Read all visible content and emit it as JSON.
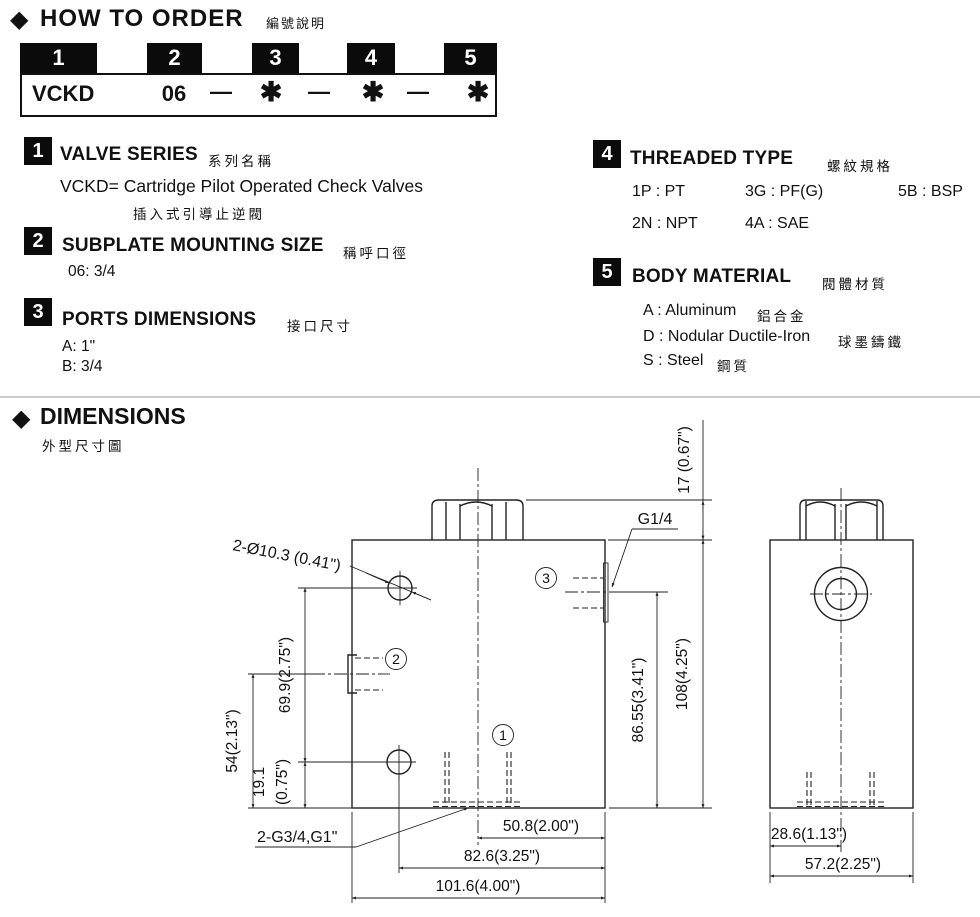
{
  "header": {
    "diamond": "◆",
    "title": "HOW TO ORDER",
    "title_zh": "編號說明"
  },
  "code_table": {
    "numbers": [
      "1",
      "2",
      "3",
      "4",
      "5"
    ],
    "model": "VCKD",
    "size": "06",
    "dash": "—",
    "star": "✱"
  },
  "sections": {
    "s1": {
      "num": "1",
      "title": "VALVE SERIES",
      "zh": "系列名稱",
      "line1": "VCKD=  Cartridge Pilot Operated Check Valves",
      "line2": "插入式引導止逆閥"
    },
    "s2": {
      "num": "2",
      "title": "SUBPLATE MOUNTING SIZE",
      "zh": "稱呼口徑",
      "line1": "06: 3/4"
    },
    "s3": {
      "num": "3",
      "title": "PORTS DIMENSIONS",
      "zh": "接口尺寸",
      "line1": "A: 1\"",
      "line2": "B: 3/4"
    },
    "s4": {
      "num": "4",
      "title": "THREADED TYPE",
      "zh": "螺紋規格",
      "opt1": "1P : PT",
      "opt2": "3G : PF(G)",
      "opt3": "5B : BSP",
      "opt4": "2N : NPT",
      "opt5": "4A : SAE"
    },
    "s5": {
      "num": "5",
      "title": "BODY MATERIAL",
      "zh": "閥體材質",
      "item1": "A : Aluminum",
      "item1_zh": "鋁合金",
      "item2": "D : Nodular Ductile-Iron",
      "item2_zh": "球墨鑄鐵",
      "item3": "S : Steel",
      "item3_zh": "鋼質"
    }
  },
  "dimensions": {
    "diamond": "◆",
    "title": "DIMENSIONS",
    "title_zh": "外型尺寸圖",
    "labels": {
      "mount_holes": "2-Ø10.3 (0.41\")",
      "pilot_port": "G1/4",
      "bottom_ports": "2-G3/4,G1\"",
      "cap_height": "17 (0.67\")",
      "v_69_9": "69.9(2.75\")",
      "v_54": "54(2.13\")",
      "v_19_1a": "19.1",
      "v_19_1b": "(0.75\")",
      "v_86_55": "86.55(3.41\")",
      "v_108": "108(4.25\")",
      "h_50_8": "50.8(2.00\")",
      "h_82_6": "82.6(3.25\")",
      "h_101_6": "101.6(4.00\")",
      "h_28_6": "28.6(1.13\")",
      "h_57_2": "57.2(2.25\")",
      "port1": "1",
      "port2": "2",
      "port3": "3"
    }
  }
}
